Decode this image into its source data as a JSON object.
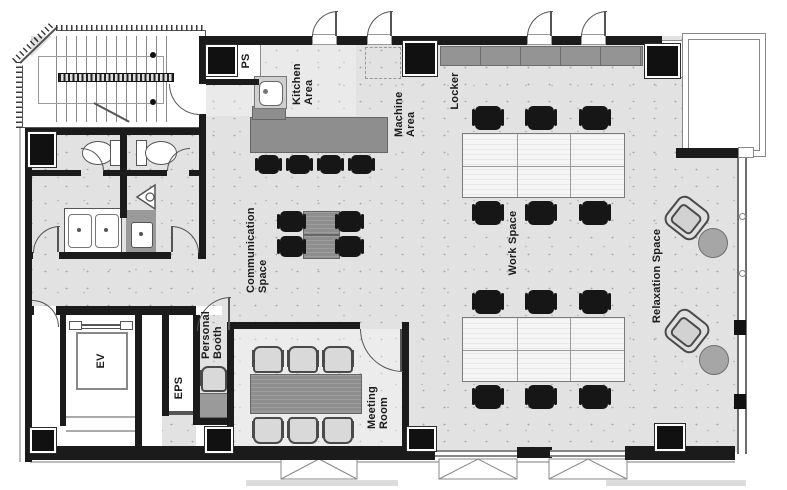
{
  "labels": {
    "ps": "PS",
    "kitchen_area": "Kitchen Area",
    "machine_area": "Machine Area",
    "locker": "Locker",
    "work_space": "Work Space",
    "communication_space": "Communication Space",
    "relaxation_space": "Relaxation Space",
    "personal_booth": "Personal Booth",
    "meeting_room": "Meeting Room",
    "eps": "EPS",
    "ev": "EV"
  },
  "colors": {
    "wall": "#1b1b1b",
    "floor": "#e2e2e2",
    "floor_dots": "#a9a9a9",
    "counter_gray": "#8e8e8e",
    "chair_black": "#161616",
    "light_chair": "#d9d9d9",
    "white": "#ffffff"
  }
}
